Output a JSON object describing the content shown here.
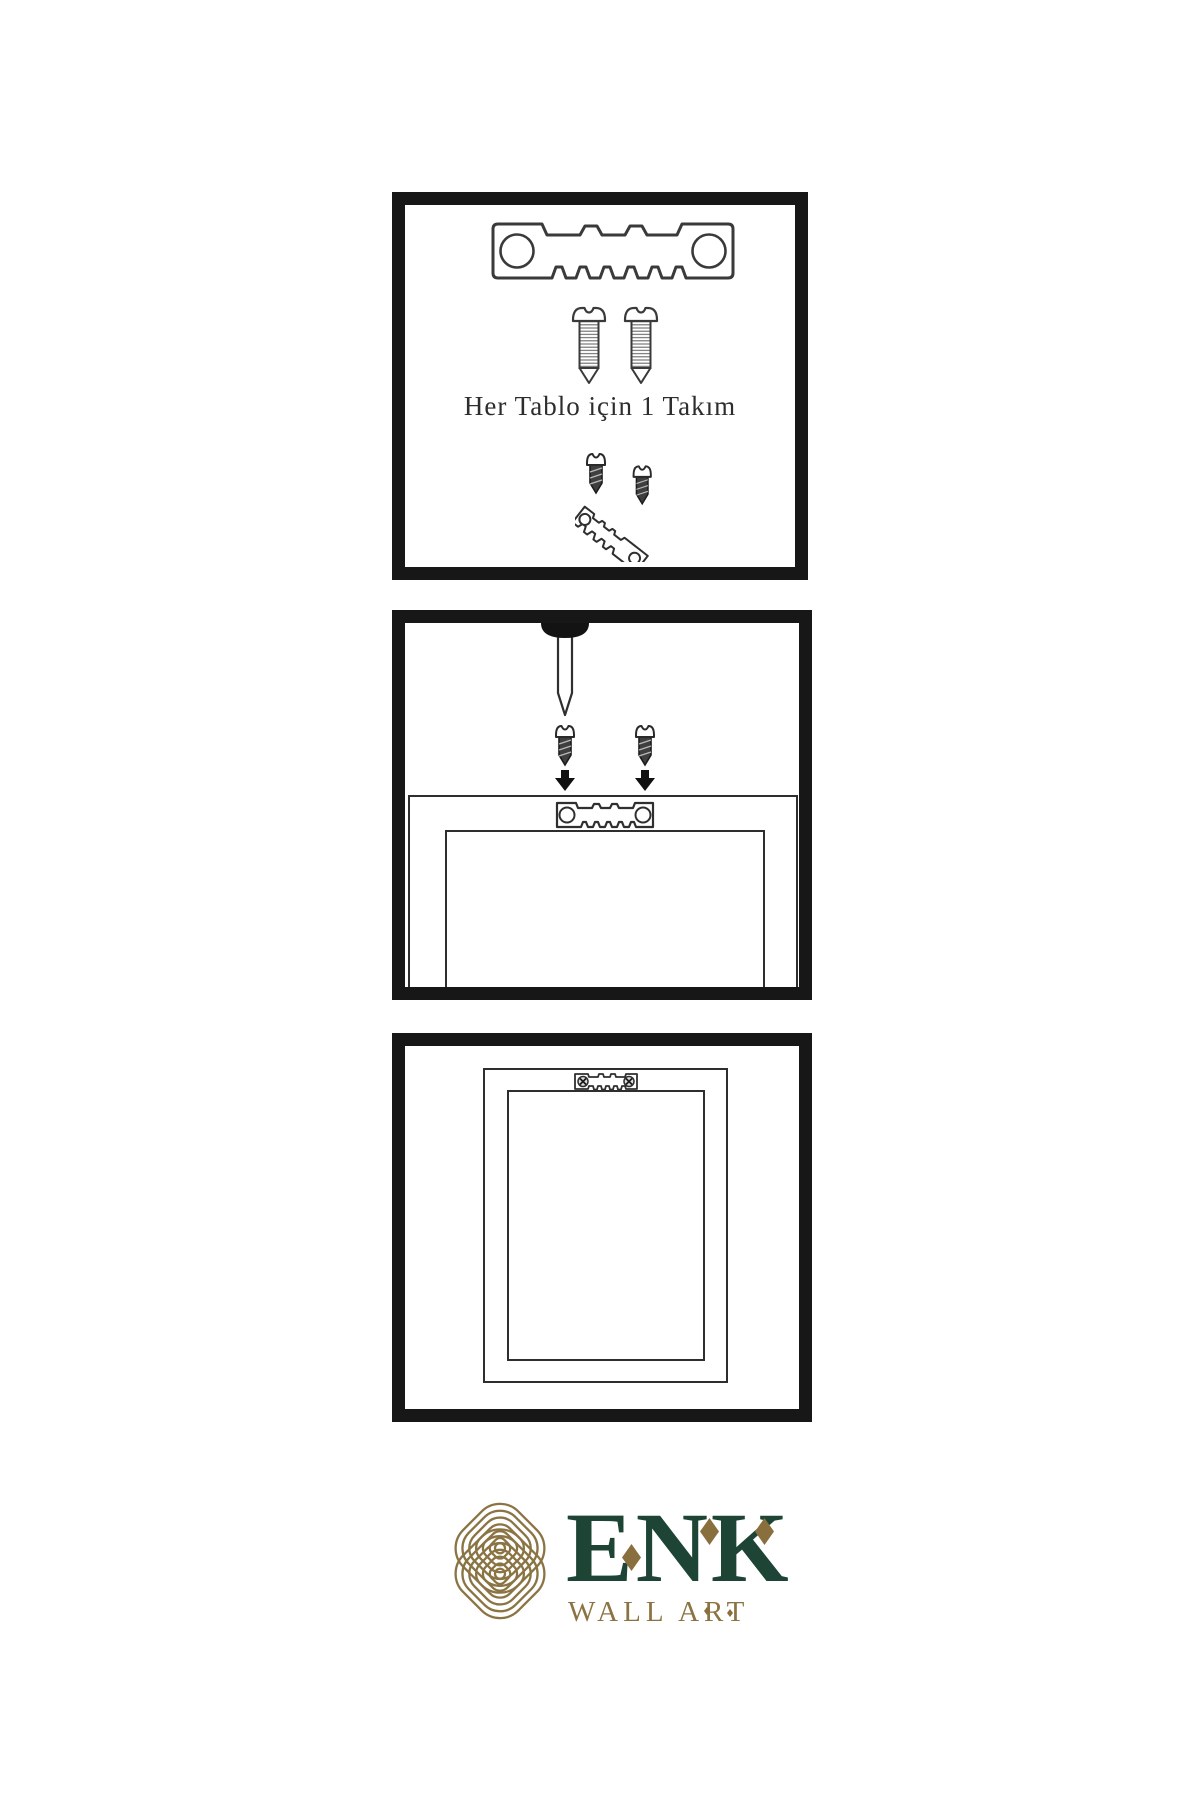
{
  "page": {
    "background": "#ffffff",
    "kind": "wall-art-hanging-instructions"
  },
  "colors": {
    "panel_border": "#171717",
    "line_ink": "#3a3a3a",
    "dark_fill": "#3f3f3f",
    "brand_green": "#1d4434",
    "brand_gold": "#8b7342"
  },
  "steps": [
    {
      "id": 1,
      "caption": "Her Tablo için 1 Takım",
      "icons": [
        "sawtooth-hanger-icon",
        "screw-icon",
        "screw-icon",
        "dark-screw-icon",
        "angled-sawtooth-hanger-icon"
      ]
    },
    {
      "id": 2,
      "caption": "",
      "icons": [
        "wall-nail-icon",
        "dark-screw-icon",
        "down-arrow-icon",
        "frame-back-icon",
        "sawtooth-hanger-icon"
      ]
    },
    {
      "id": 3,
      "caption": "",
      "icons": [
        "hung-frame-icon",
        "mounted-sawtooth-hanger-icon",
        "phillips-screw-icon"
      ]
    }
  ],
  "logo": {
    "name": "ENK",
    "subtitle": "WALL ART",
    "mark": "knot-monogram",
    "accents": [
      "diamond",
      "diamond",
      "diamond"
    ]
  }
}
